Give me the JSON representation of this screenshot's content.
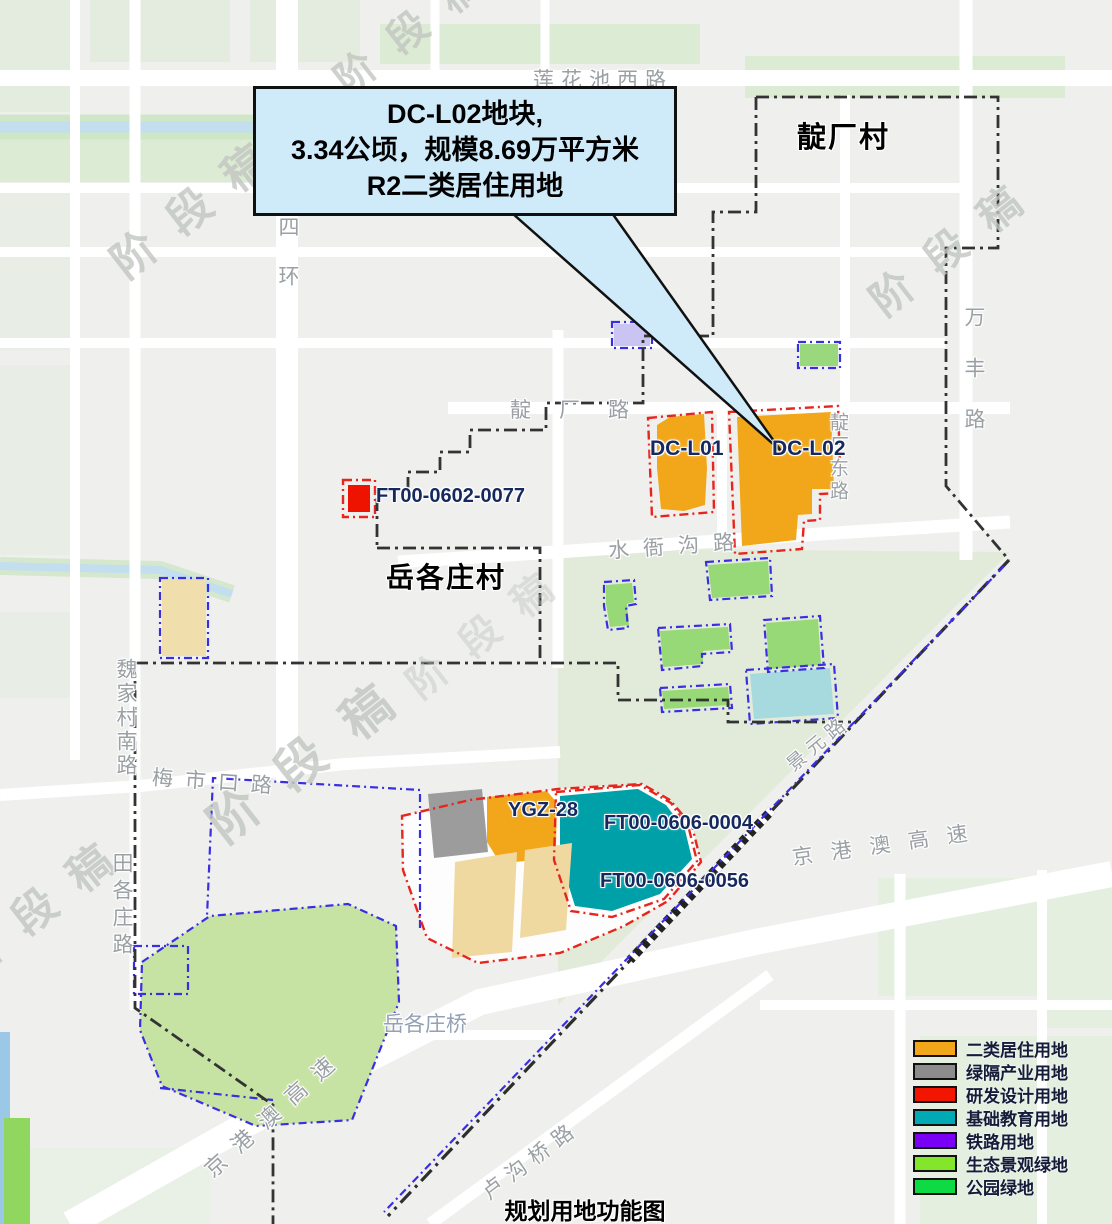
{
  "title": "规划用地功能图",
  "watermark": "阶段稿",
  "callout": {
    "line1": "DC-L02地块,",
    "line2": "3.34公顷，规模8.69万平方米",
    "line3": "R2二类居住用地"
  },
  "villages": {
    "dianchang": "靛厂村",
    "yuegezhuang": "岳各庄村"
  },
  "parcels": {
    "dc_l01": "DC-L01",
    "dc_l02": "DC-L02",
    "ft_0602_0077": "FT00-0602-0077",
    "ygz_28": "YGZ-28",
    "ft_0606_0004": "FT00-0606-0004",
    "ft_0606_0056": "FT00-0606-0056"
  },
  "roads": {
    "lianhuachi_west": "莲花池西路",
    "sihuan": "四环",
    "dianchang_rd": "靛厂路",
    "shuiyagou_rd": "水衙沟路",
    "dianchang_east_rd": "靛厂东路",
    "wanfeng_rd": "万丰路",
    "weijiacun_south_rd": "魏家村南路",
    "meishikou_rd": "梅市口路",
    "tiangezhuang_rd": "田各庄路",
    "yuegezhuang_bridge": "岳各庄桥",
    "jinggangao_expwy": "京港澳高速",
    "lugouqiao_rd": "卢沟桥路",
    "jingyuan_rd": "景元路"
  },
  "legend": {
    "items": [
      {
        "label": "二类居住用地",
        "color": "#F2A71B"
      },
      {
        "label": "绿隔产业用地",
        "color": "#8C8C8C"
      },
      {
        "label": "研发设计用地",
        "color": "#F21500"
      },
      {
        "label": "基础教育用地",
        "color": "#00A9B4"
      },
      {
        "label": "铁路用地",
        "color": "#7A00F5"
      },
      {
        "label": "生态景观绿地",
        "color": "#84E62A"
      },
      {
        "label": "公园绿地",
        "color": "#0EDB43"
      }
    ]
  }
}
